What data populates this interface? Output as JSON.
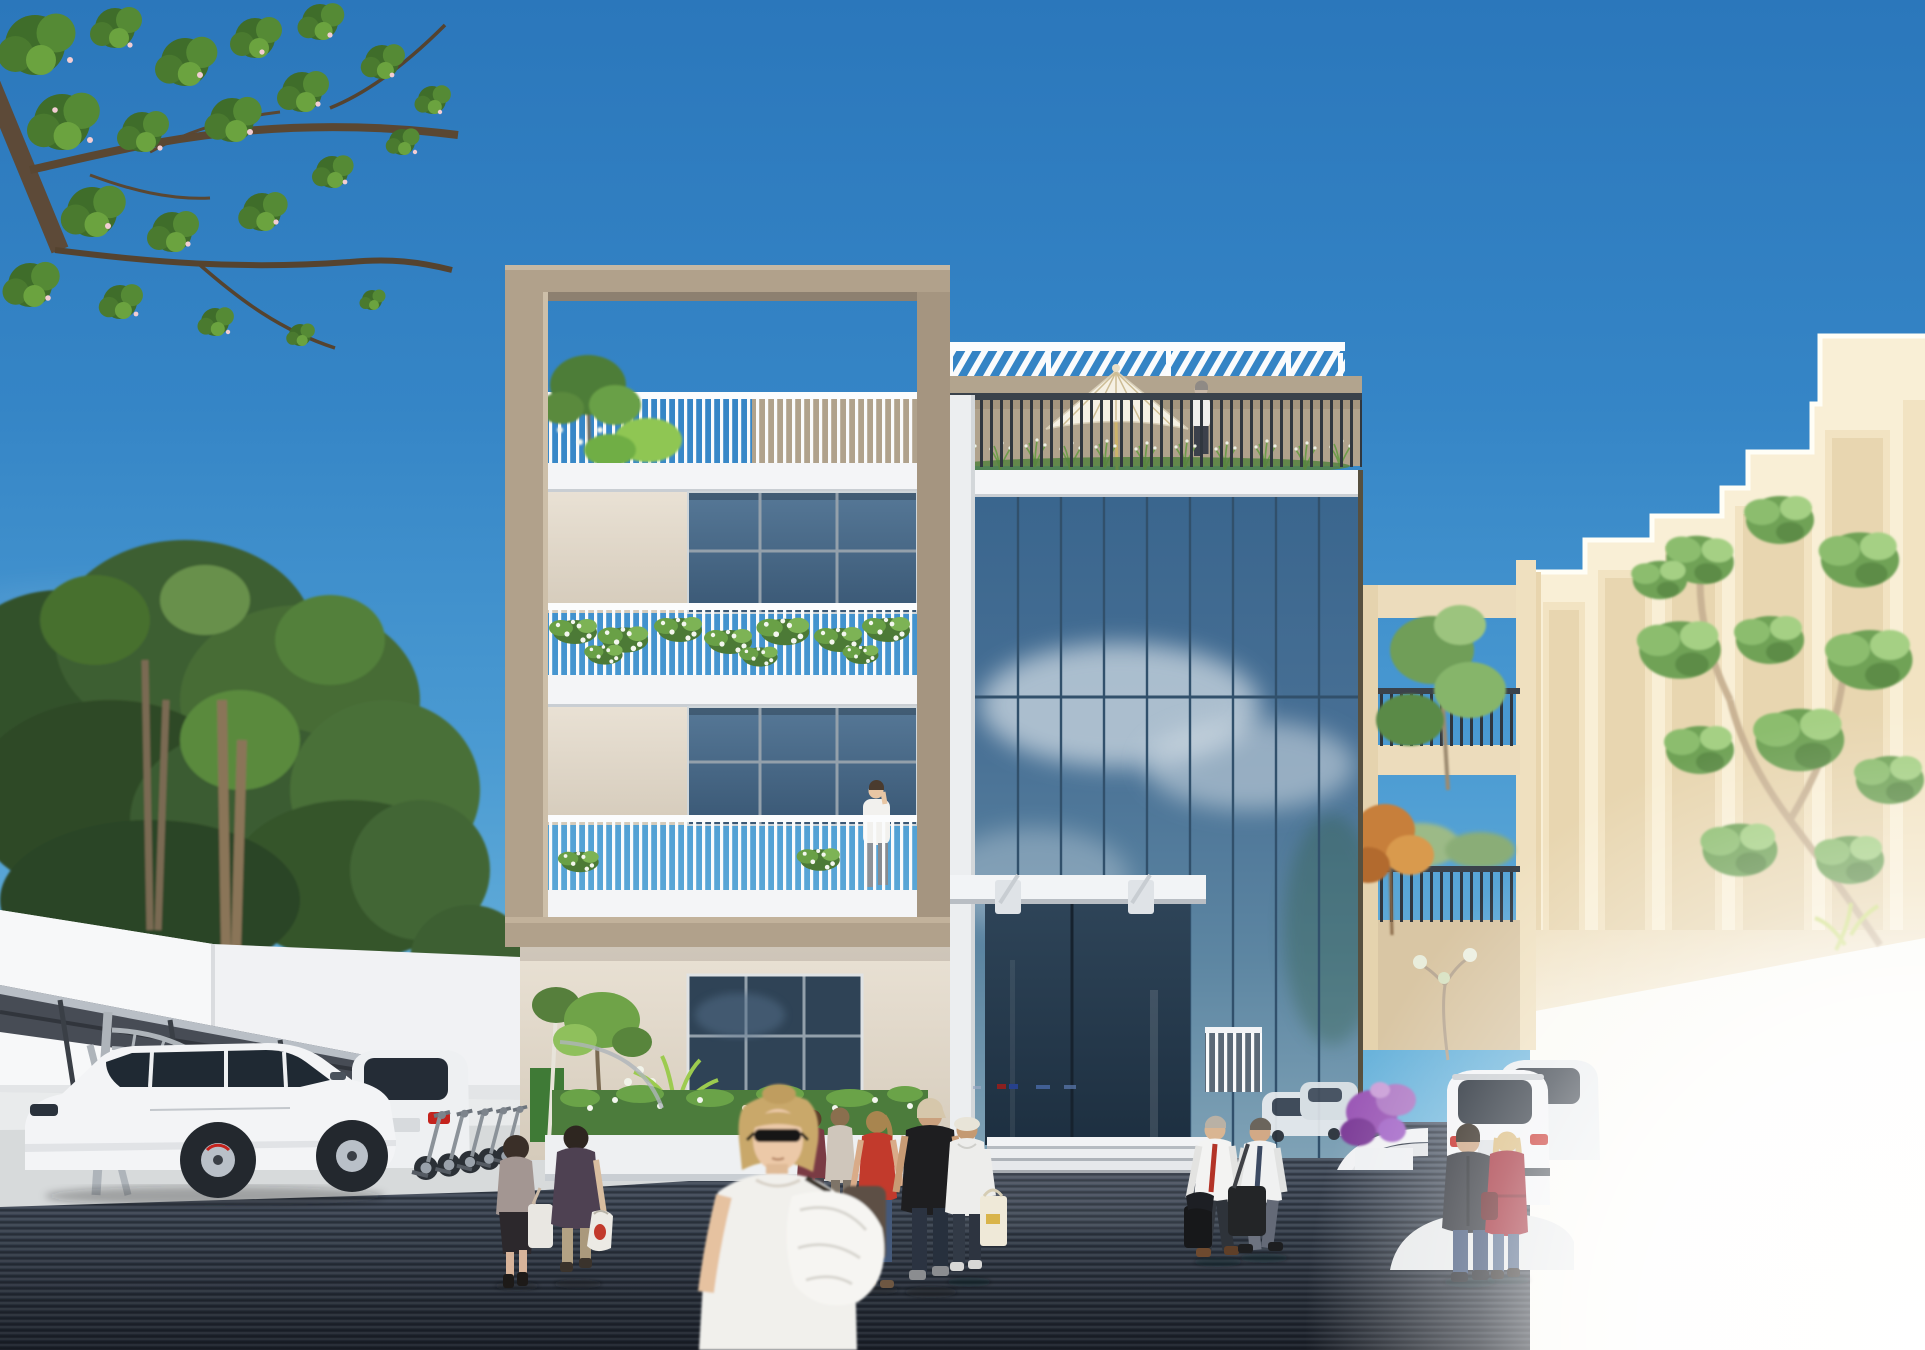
{
  "meta": {
    "kind": "architectural-exterior-rendering",
    "description": "Photoreal 3D visualization of a modern 4-storey mixed-use building with a tan concrete portal frame, planted white balconies, a blue glass curtain-wall tower with rooftop pergola terrace, an ivory neighbouring building, street trees, a carport with white SUVs, and pedestrians on a dark striped plaza under a clear blue sky.",
    "time_of_day": "midday",
    "visible_text": ""
  },
  "palette": {
    "sky_top": "#2b77bb",
    "sky_horizon": "#8ec8e4",
    "tan_frame": "#b1a18b",
    "tan_frame_shadow": "#8d8070",
    "parapet": "#b2a48e",
    "cream_wall": "#e2d9cc",
    "white_trim": "#f4f5f7",
    "window_glass": "#46637f",
    "curtain_glass_top": "#3a668e",
    "curtain_glass_bottom": "#7fa2b6",
    "railing_dark": "#30373f",
    "right_building_lit": "#f9efd6",
    "right_building_panel": "#f2e3c2",
    "paving_top": "#4b5565",
    "paving_bottom": "#1f252f",
    "apron": "#d7dadb",
    "foliage_dark": "#3c5f31",
    "foliage_mid": "#5a8a3e",
    "foliage_light": "#7fb84b",
    "tree_right_green": "#79a862",
    "umbrella": "#f6f1e4",
    "carport_roof": "#474c55",
    "suv_white": "#f2f3f5",
    "taillight_red": "#c4231d",
    "red_coat": "#9e2430",
    "red_top": "#c23a2c",
    "purple_flowers": "#9b59b6"
  },
  "scene": {
    "sky": {
      "description": "clear blue gradient sky, faint haze near horizon"
    },
    "overhanging_branch": {
      "position": "top-left",
      "description": "tree branch with green leaves and pale pink blossoms"
    },
    "left_backdrop": {
      "trees": "dense park trees behind boundary",
      "wall": "white plastered boundary wall"
    },
    "carport": {
      "structure": "grey steel cantilevered carport with curved lattice supports",
      "vehicles": [
        "white SUV, side view",
        "white SUV, rear three-quarter view"
      ],
      "scooter_count": 5
    },
    "main_building": {
      "left_block": {
        "frame": "warm tan concrete portal frame",
        "walls": "cream stucco with blue-grey gridded windows",
        "railings": "white vertical-slat balustrades",
        "planting": "trailing white-flowered planters on two levels and roof terrace shrubs"
      },
      "glass_tower": {
        "facade": "blue reflective curtain wall with cloud reflections",
        "roof_terrace": {
          "pergola": "white louvred canopy",
          "railing": "dark metal balustrade with ornamental grasses",
          "umbrella": "cream patio umbrella",
          "person": "figure standing at the railing"
        },
        "entrance": {
          "canopy": "white steel canopy on brackets",
          "glazing": "recessed dark glass",
          "steps": 3,
          "side_gate": "white slatted gate"
        },
        "reflections": [
          "clouds",
          "tree",
          "white cars near ground"
        ]
      }
    },
    "link_block": {
      "description": "cream open-frame connector with two dark-railed balconies, sky visible through openings",
      "planting": [
        "green tree",
        "orange-leaved shrub",
        "white frangipani sapling"
      ]
    },
    "right_building": {
      "description": "ivory building with stepped parapet and recessed window bays, lower part overexposed",
      "tree": "large sunlit green tree in front"
    },
    "plaza": {
      "paving": "dark blue-grey linear striped pavers",
      "features": [
        "light concrete apron",
        "white entrance steps",
        "curved white kerb island",
        "planter with purple bougainvillea"
      ],
      "lighting": "bottom-right corner blown out to white"
    },
    "people": [
      {
        "id": "balcony-man",
        "description": "man in white shirt on phone, level-2 balcony"
      },
      {
        "id": "roof-person",
        "description": "person at rooftop railing beside umbrella"
      },
      {
        "id": "shopper-grey",
        "description": "woman in grey top, dark skirt, white tote, walking away"
      },
      {
        "id": "shopper-plum",
        "description": "short-haired person in plum jacket with plastic bag, walking away"
      },
      {
        "id": "foreground-woman",
        "description": "blonde woman, sunglasses, white tee, white jacket over arm, slightly motion-blurred"
      },
      {
        "id": "background-pair",
        "description": "two pedestrians behind the foreground woman"
      },
      {
        "id": "red-top-woman",
        "description": "woman in red tank top and jeans"
      },
      {
        "id": "black-tee-man",
        "description": "man in black tee and beige cap"
      },
      {
        "id": "white-jacket-man",
        "description": "man in white jacket, bucket hat, cream tote"
      },
      {
        "id": "businessman-red-tie",
        "description": "businessman, white shirt, red tie, briefcase"
      },
      {
        "id": "businessman-blue-tie",
        "description": "businessman, white shirt, dark tie, shoulder bag"
      },
      {
        "id": "leather-jacket-man",
        "description": "man in dark jacket and jeans, back view"
      },
      {
        "id": "red-coat-woman",
        "description": "blonde woman in red coat and jeans, back view"
      }
    ]
  }
}
